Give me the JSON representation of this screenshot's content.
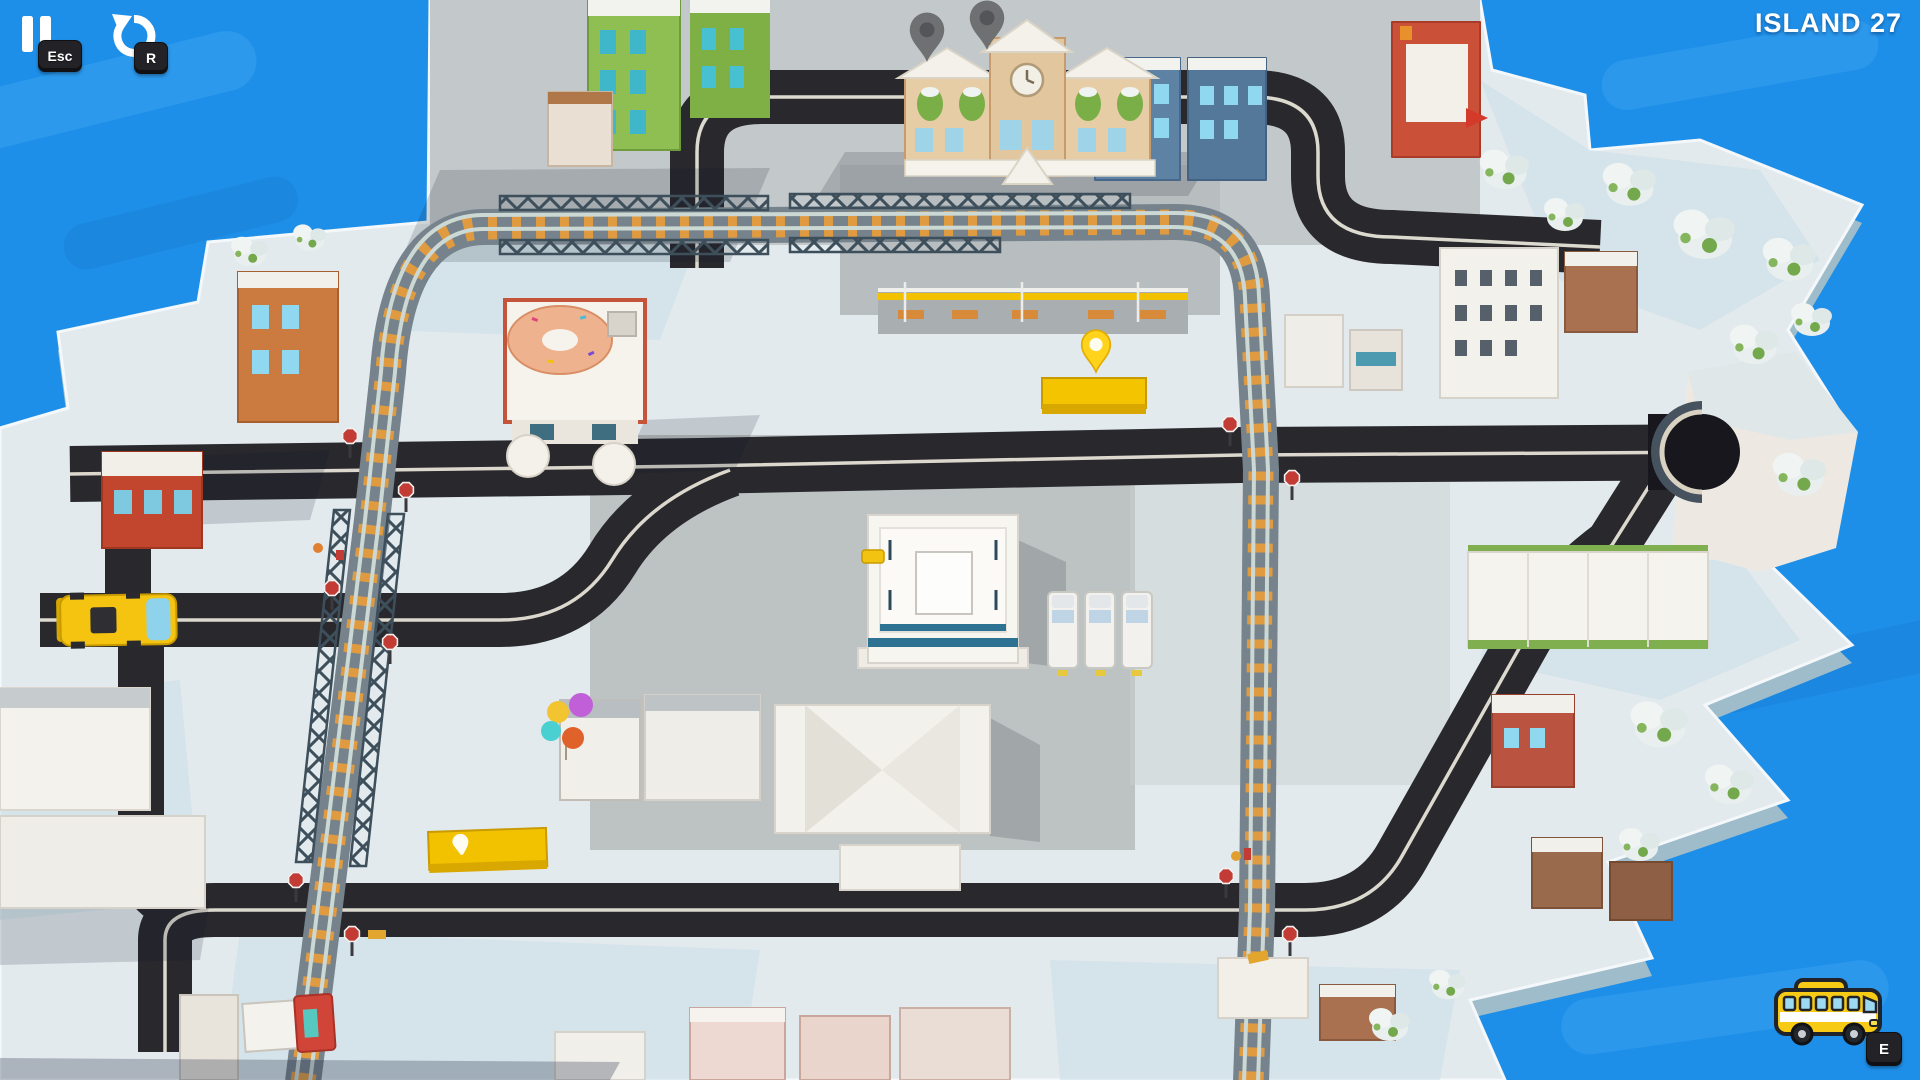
{
  "hud": {
    "pause_key": "Esc",
    "restart_key": "R",
    "bus_key": "E",
    "level_title": "Island 27",
    "icons": {
      "pause": "pause-icon",
      "restart": "restart-arrow-icon",
      "bus": "bus-icon",
      "stop_marker": "location-pin-icon",
      "station_marker": "map-pin-icon",
      "crossing_sign": "stop-sign-icon"
    }
  },
  "colors": {
    "water": "#1E8FE8",
    "snow_ground": "#E3EAEE",
    "road": "#28282D",
    "rail_tie_orange": "#E09B40",
    "rail_base": "#76838C",
    "truss_steel": "#3E4F5C",
    "bus_yellow": "#F6C81A",
    "stop_pin_yellow": "#FFD21C",
    "station_wall": "#E7CDA6",
    "keycap_dark": "#232327"
  }
}
